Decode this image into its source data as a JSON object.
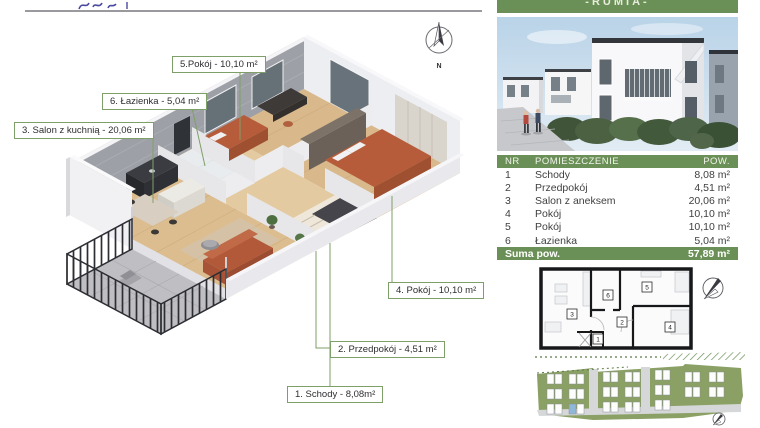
{
  "banner": {
    "location": "-RUMIA-"
  },
  "compass": {
    "north_label": "N"
  },
  "plan3d_labels": {
    "room5": "5.Pokój - 10,10 m²",
    "room6": "6. Łazienka - 5,04 m²",
    "room3": "3. Salon z kuchnią - 20,06 m²",
    "room4": "4. Pokój - 10,10 m²",
    "room2": "2. Przedpokój - 4,51 m²",
    "room1": "1. Schody - 8,08m²"
  },
  "area_table": {
    "columns": [
      "NR",
      "POMIESZCZENIE",
      "POW."
    ],
    "rows": [
      {
        "nr": "1",
        "name": "Schody",
        "area": "8,08 m²"
      },
      {
        "nr": "2",
        "name": "Przedpokój",
        "area": "4,51 m²"
      },
      {
        "nr": "3",
        "name": "Salon z aneksem",
        "area": "20,06 m²"
      },
      {
        "nr": "4",
        "name": "Pokój",
        "area": "10,10 m²"
      },
      {
        "nr": "5",
        "name": "Pokój",
        "area": "10,10 m²"
      },
      {
        "nr": "6",
        "name": "Łazienka",
        "area": "5,04 m²"
      }
    ],
    "summary_label": "Suma pow.",
    "summary_value": "57,89 m²"
  },
  "plan2d": {
    "rooms": [
      "1",
      "2",
      "3",
      "4",
      "5",
      "6"
    ]
  },
  "colors": {
    "accent_green": "#6b9057",
    "label_border": "#7f9f68",
    "highlight_unit": "#8fb8d8"
  }
}
